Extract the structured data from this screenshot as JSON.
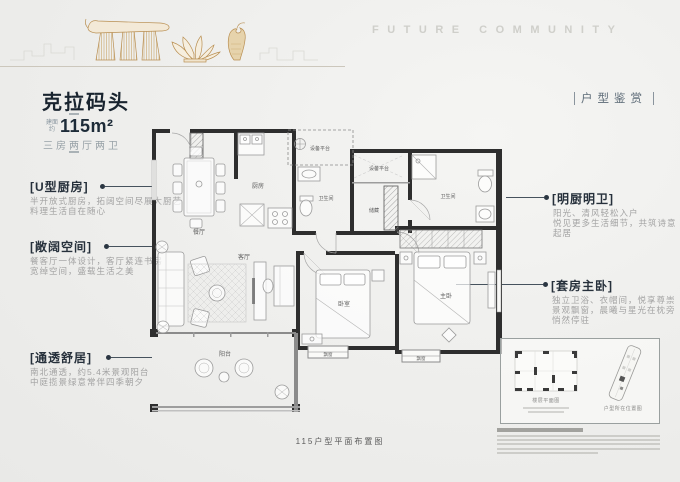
{
  "header": {
    "wordmark": "FUTURE COMMUNITY",
    "right_tag": "户型鉴赏"
  },
  "title_block": {
    "name": "克拉码头",
    "area_prefix_top": "建面",
    "area_prefix_bottom": "约",
    "area_value": "115m²",
    "subtitle": "三房两厅两卫"
  },
  "annotations": {
    "left": [
      {
        "label": "[U型厨房]",
        "lines": [
          "半开放式厨房，拓阔空间尽展大厨艺",
          "料理生活自在随心"
        ]
      },
      {
        "label": "[敞阔空间]",
        "lines": [
          "餐客厅一体设计，客厅紧连书房",
          "宽绰空间，盛载生活之美"
        ]
      },
      {
        "label": "[通透舒居]",
        "lines": [
          "南北通透，约5.4米景观阳台",
          "中庭揽景绿意常伴四季朝夕"
        ]
      }
    ],
    "right": [
      {
        "label": "[明厨明卫]",
        "lines": [
          "阳光、清风轻松入户",
          "悦见更多生活细节，共筑诗意起居"
        ]
      },
      {
        "label": "[套房主卧]",
        "lines": [
          "独立卫浴、衣帽间，悦享尊崇",
          "景观飘窗，晨曦与星光在枕旁悄然停驻"
        ]
      }
    ]
  },
  "floorplan": {
    "rooms": {
      "dining": "餐厅",
      "kitchen": "厨房",
      "bath1": "卫生间",
      "bath2": "卫生间",
      "equip1": "设备平台",
      "equip2": "设备平台",
      "storage": "储藏",
      "living": "客厅",
      "balcony": "阳台",
      "bedroom": "卧室",
      "master": "主卧",
      "bay1": "飘窗",
      "bay2": "飘窗"
    }
  },
  "caption": "115户型平面布置图",
  "keyplan": {
    "left_label": "楼层平面图",
    "right_label": "户型所在位置图"
  },
  "colors": {
    "accent_navy": "#19242f",
    "gold": "#b98f52",
    "wall_dark": "#2e2e2e",
    "text_gray": "#a3a3a3",
    "background": "#efefed"
  }
}
